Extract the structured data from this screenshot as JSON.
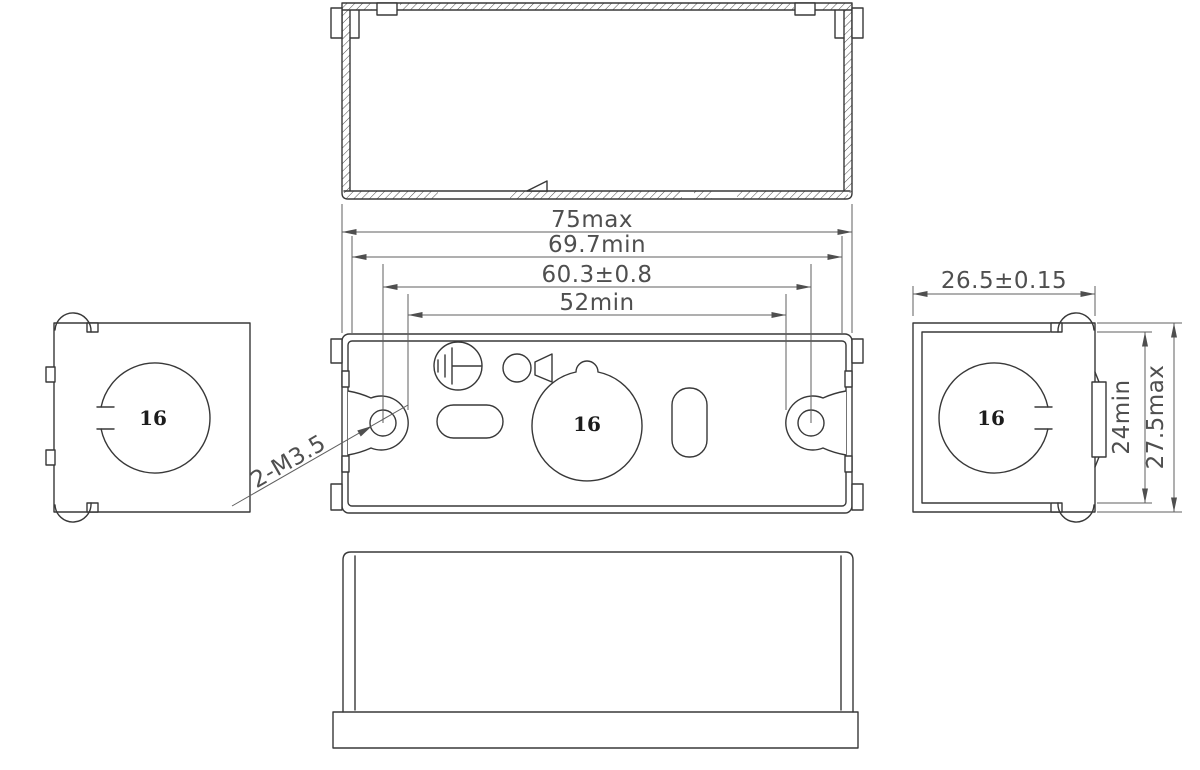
{
  "drawing": {
    "type": "technical-orthographic-drawing",
    "part": "rectangular enclosure / mounting box, five views with section hatching",
    "dimensions": {
      "width_max": "75max",
      "width_min": "69.7min",
      "hole_spacing": "60.3±0.8",
      "slot_span": "52min",
      "side_width": "26.5±0.15",
      "side_depth_min": "24min",
      "side_depth_max": "27.5max"
    },
    "annotations": {
      "screw_spec": "2-M3.5"
    },
    "knockouts": {
      "front": "16",
      "left": "16",
      "right": "16"
    },
    "symbols": [
      "earth-ground-symbol",
      "cable-entry-symbol"
    ],
    "colors": {
      "background": "#ffffff",
      "line": "#383838",
      "dim_line": "#5f5f5f",
      "dim_text": "#4f4f4f",
      "knockout_text": "#1c1c1c"
    }
  }
}
